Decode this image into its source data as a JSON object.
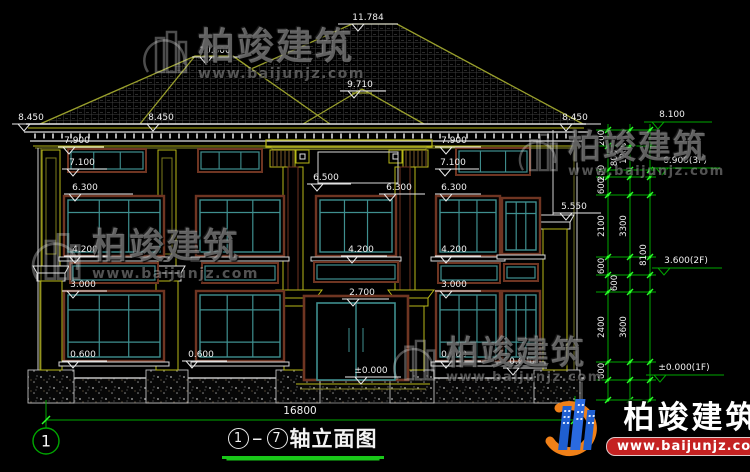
{
  "drawing": {
    "title": {
      "axis_start": "1",
      "axis_end": "7",
      "text": "轴立面图"
    },
    "overall_width_dim": {
      "label": "16800",
      "x": 300,
      "y": 414
    },
    "axis_bubble": {
      "label": "1",
      "x": 46,
      "y": 441
    },
    "elevation_marks": [
      {
        "label": "11.784",
        "tx": 368,
        "ty": 20,
        "x1": 338,
        "x2": 398,
        "ly": 24,
        "tri": 358,
        "color": "#ededed"
      },
      {
        "label": "10.800",
        "tx": 215,
        "ty": 53,
        "x1": 192,
        "x2": 242,
        "ly": 57,
        "tri": 206,
        "color": "#ededed"
      },
      {
        "label": "9.710",
        "tx": 360,
        "ty": 87,
        "x1": 340,
        "x2": 386,
        "ly": 91,
        "tri": 354,
        "color": "#ededed"
      },
      {
        "label": "8.450",
        "tx": 31,
        "ty": 120,
        "x1": 12,
        "x2": 60,
        "ly": 124,
        "tri": 24,
        "color": "#ededed"
      },
      {
        "label": "8.450",
        "tx": 161,
        "ty": 120,
        "x1": 141,
        "x2": 189,
        "ly": 124,
        "tri": 153,
        "color": "#ededed"
      },
      {
        "label": "8.450",
        "tx": 575,
        "ty": 120,
        "x1": 553,
        "x2": 601,
        "ly": 124,
        "tri": 566,
        "color": "#ededed"
      },
      {
        "label": "7.900",
        "tx": 77,
        "ty": 143,
        "x1": 58,
        "x2": 104,
        "ly": 147,
        "tri": 69,
        "color": "#ededed"
      },
      {
        "label": "7.900",
        "tx": 454,
        "ty": 143,
        "x1": 435,
        "x2": 481,
        "ly": 147,
        "tri": 446,
        "color": "#ededed"
      },
      {
        "label": "7.100",
        "tx": 82,
        "ty": 165,
        "x1": 62,
        "x2": 107,
        "ly": 169,
        "tri": 73,
        "color": "#ededed"
      },
      {
        "label": "7.100",
        "tx": 453,
        "ty": 165,
        "x1": 435,
        "x2": 479,
        "ly": 169,
        "tri": 445,
        "color": "#ededed"
      },
      {
        "label": "6.500",
        "tx": 326,
        "ty": 180,
        "x1": 307,
        "x2": 351,
        "ly": 184,
        "tri": 317,
        "color": "#ededed"
      },
      {
        "label": "6.300",
        "tx": 85,
        "ty": 190,
        "x1": 64,
        "x2": 133,
        "ly": 194,
        "tri": 75,
        "color": "#ededed"
      },
      {
        "label": "6.300",
        "tx": 399,
        "ty": 190,
        "x1": 379,
        "x2": 425,
        "ly": 194,
        "tri": 390,
        "color": "#ededed"
      },
      {
        "label": "6.300",
        "tx": 454,
        "ty": 190,
        "x1": 435,
        "x2": 481,
        "ly": 194,
        "tri": 446,
        "color": "#ededed"
      },
      {
        "label": "5.550",
        "tx": 574,
        "ty": 209,
        "x1": 553,
        "x2": 601,
        "ly": 213,
        "tri": 566,
        "color": "#ededed"
      },
      {
        "label": "4.200",
        "tx": 85,
        "ty": 252,
        "x1": 64,
        "x2": 110,
        "ly": 256,
        "tri": 75,
        "color": "#ededed"
      },
      {
        "label": "4.200",
        "tx": 361,
        "ty": 252,
        "x1": 341,
        "x2": 387,
        "ly": 256,
        "tri": 352,
        "color": "#ededed"
      },
      {
        "label": "4.200",
        "tx": 454,
        "ty": 252,
        "x1": 435,
        "x2": 481,
        "ly": 256,
        "tri": 446,
        "color": "#ededed"
      },
      {
        "label": "3.000",
        "tx": 83,
        "ty": 287,
        "x1": 62,
        "x2": 107,
        "ly": 291,
        "tri": 73,
        "color": "#ededed"
      },
      {
        "label": "3.000",
        "tx": 454,
        "ty": 287,
        "x1": 435,
        "x2": 481,
        "ly": 291,
        "tri": 446,
        "color": "#ededed"
      },
      {
        "label": "2.700",
        "tx": 362,
        "ty": 295,
        "x1": 342,
        "x2": 389,
        "ly": 299,
        "tri": 353,
        "color": "#ededed"
      },
      {
        "label": "0.600",
        "tx": 83,
        "ty": 357,
        "x1": 62,
        "x2": 107,
        "ly": 361,
        "tri": 73,
        "color": "#ededed"
      },
      {
        "label": "0.600",
        "tx": 201,
        "ty": 357,
        "x1": 182,
        "x2": 227,
        "ly": 361,
        "tri": 192,
        "color": "#ededed"
      },
      {
        "label": "0.600",
        "tx": 454,
        "ty": 357,
        "x1": 435,
        "x2": 481,
        "ly": 361,
        "tri": 446,
        "color": "#ededed"
      },
      {
        "label": "0.600",
        "tx": 522,
        "ty": 364,
        "x1": 503,
        "x2": 547,
        "ly": 368,
        "tri": 513,
        "color": "#ededed"
      },
      {
        "label": "±0.000",
        "tx": 371,
        "ty": 373,
        "x1": 345,
        "x2": 401,
        "ly": 377,
        "tri": 361,
        "color": "#ededed"
      }
    ],
    "floor_level_marks": [
      {
        "label": "8.100",
        "tx": 672,
        "ty": 117,
        "x1": 644,
        "x2": 712,
        "ly": 122,
        "tri": 658,
        "level_y": 130
      },
      {
        "label": "6.900(3F)",
        "tx": 685,
        "ty": 163,
        "x1": 650,
        "x2": 720,
        "ly": 168,
        "tri": 662,
        "level_y": 177
      },
      {
        "label": "3.600(2F)",
        "tx": 686,
        "ty": 263,
        "x1": 652,
        "x2": 722,
        "ly": 268,
        "tri": 664,
        "level_y": 275
      },
      {
        "label": "±0.000(1F)",
        "tx": 684,
        "ty": 370,
        "x1": 646,
        "x2": 724,
        "ly": 375,
        "tri": 660,
        "level_y": 380
      }
    ],
    "right_dimension_chains": {
      "levels_y": [
        130,
        146,
        170,
        177,
        195,
        257,
        275,
        292,
        362,
        380,
        400
      ],
      "chain_line_xs": [
        608,
        630,
        650
      ],
      "tick_x1": 596,
      "tick_x2": 656,
      "dims": [
        {
          "label": "200",
          "x": 604,
          "y": 138
        },
        {
          "label": "800",
          "x": 617,
          "y": 158
        },
        {
          "label": "200",
          "x": 604,
          "y": 173
        },
        {
          "label": "600",
          "x": 604,
          "y": 186
        },
        {
          "label": "2100",
          "x": 604,
          "y": 226
        },
        {
          "label": "600",
          "x": 604,
          "y": 266
        },
        {
          "label": "600",
          "x": 617,
          "y": 283
        },
        {
          "label": "2400",
          "x": 604,
          "y": 327
        },
        {
          "label": "600",
          "x": 604,
          "y": 371
        },
        {
          "label": "1200",
          "x": 626,
          "y": 153
        },
        {
          "label": "3300",
          "x": 626,
          "y": 226
        },
        {
          "label": "3600",
          "x": 626,
          "y": 327
        },
        {
          "label": "8100",
          "x": 646,
          "y": 255
        }
      ]
    },
    "colors": {
      "background": "#000000",
      "dim_green": "#00a800",
      "node_green": "#2aff2a",
      "roof_line": "#9aa02c",
      "accent_yellow": "#b9b918",
      "white_line": "#e0e0e0",
      "window_teal": "#3f8f8f",
      "frame_maroon": "#6f3522",
      "text_white": "#f0f0f0",
      "logo_red": "#c42222",
      "logo_orange": "#f08018",
      "logo_blue": "#1f5fd0"
    }
  },
  "watermarks": [
    {
      "brand": "柏竣建筑",
      "url": "www.baijunjz.com"
    },
    {
      "brand": "柏竣建筑",
      "url": "www.baijunjz.com"
    },
    {
      "brand": "柏竣建筑",
      "url": "www.baijunjz.com"
    },
    {
      "brand": "柏竣建筑",
      "url": "www.baijunjz.com"
    }
  ],
  "logo": {
    "brand": "柏竣建筑",
    "url": "www.baijunjz.com"
  }
}
